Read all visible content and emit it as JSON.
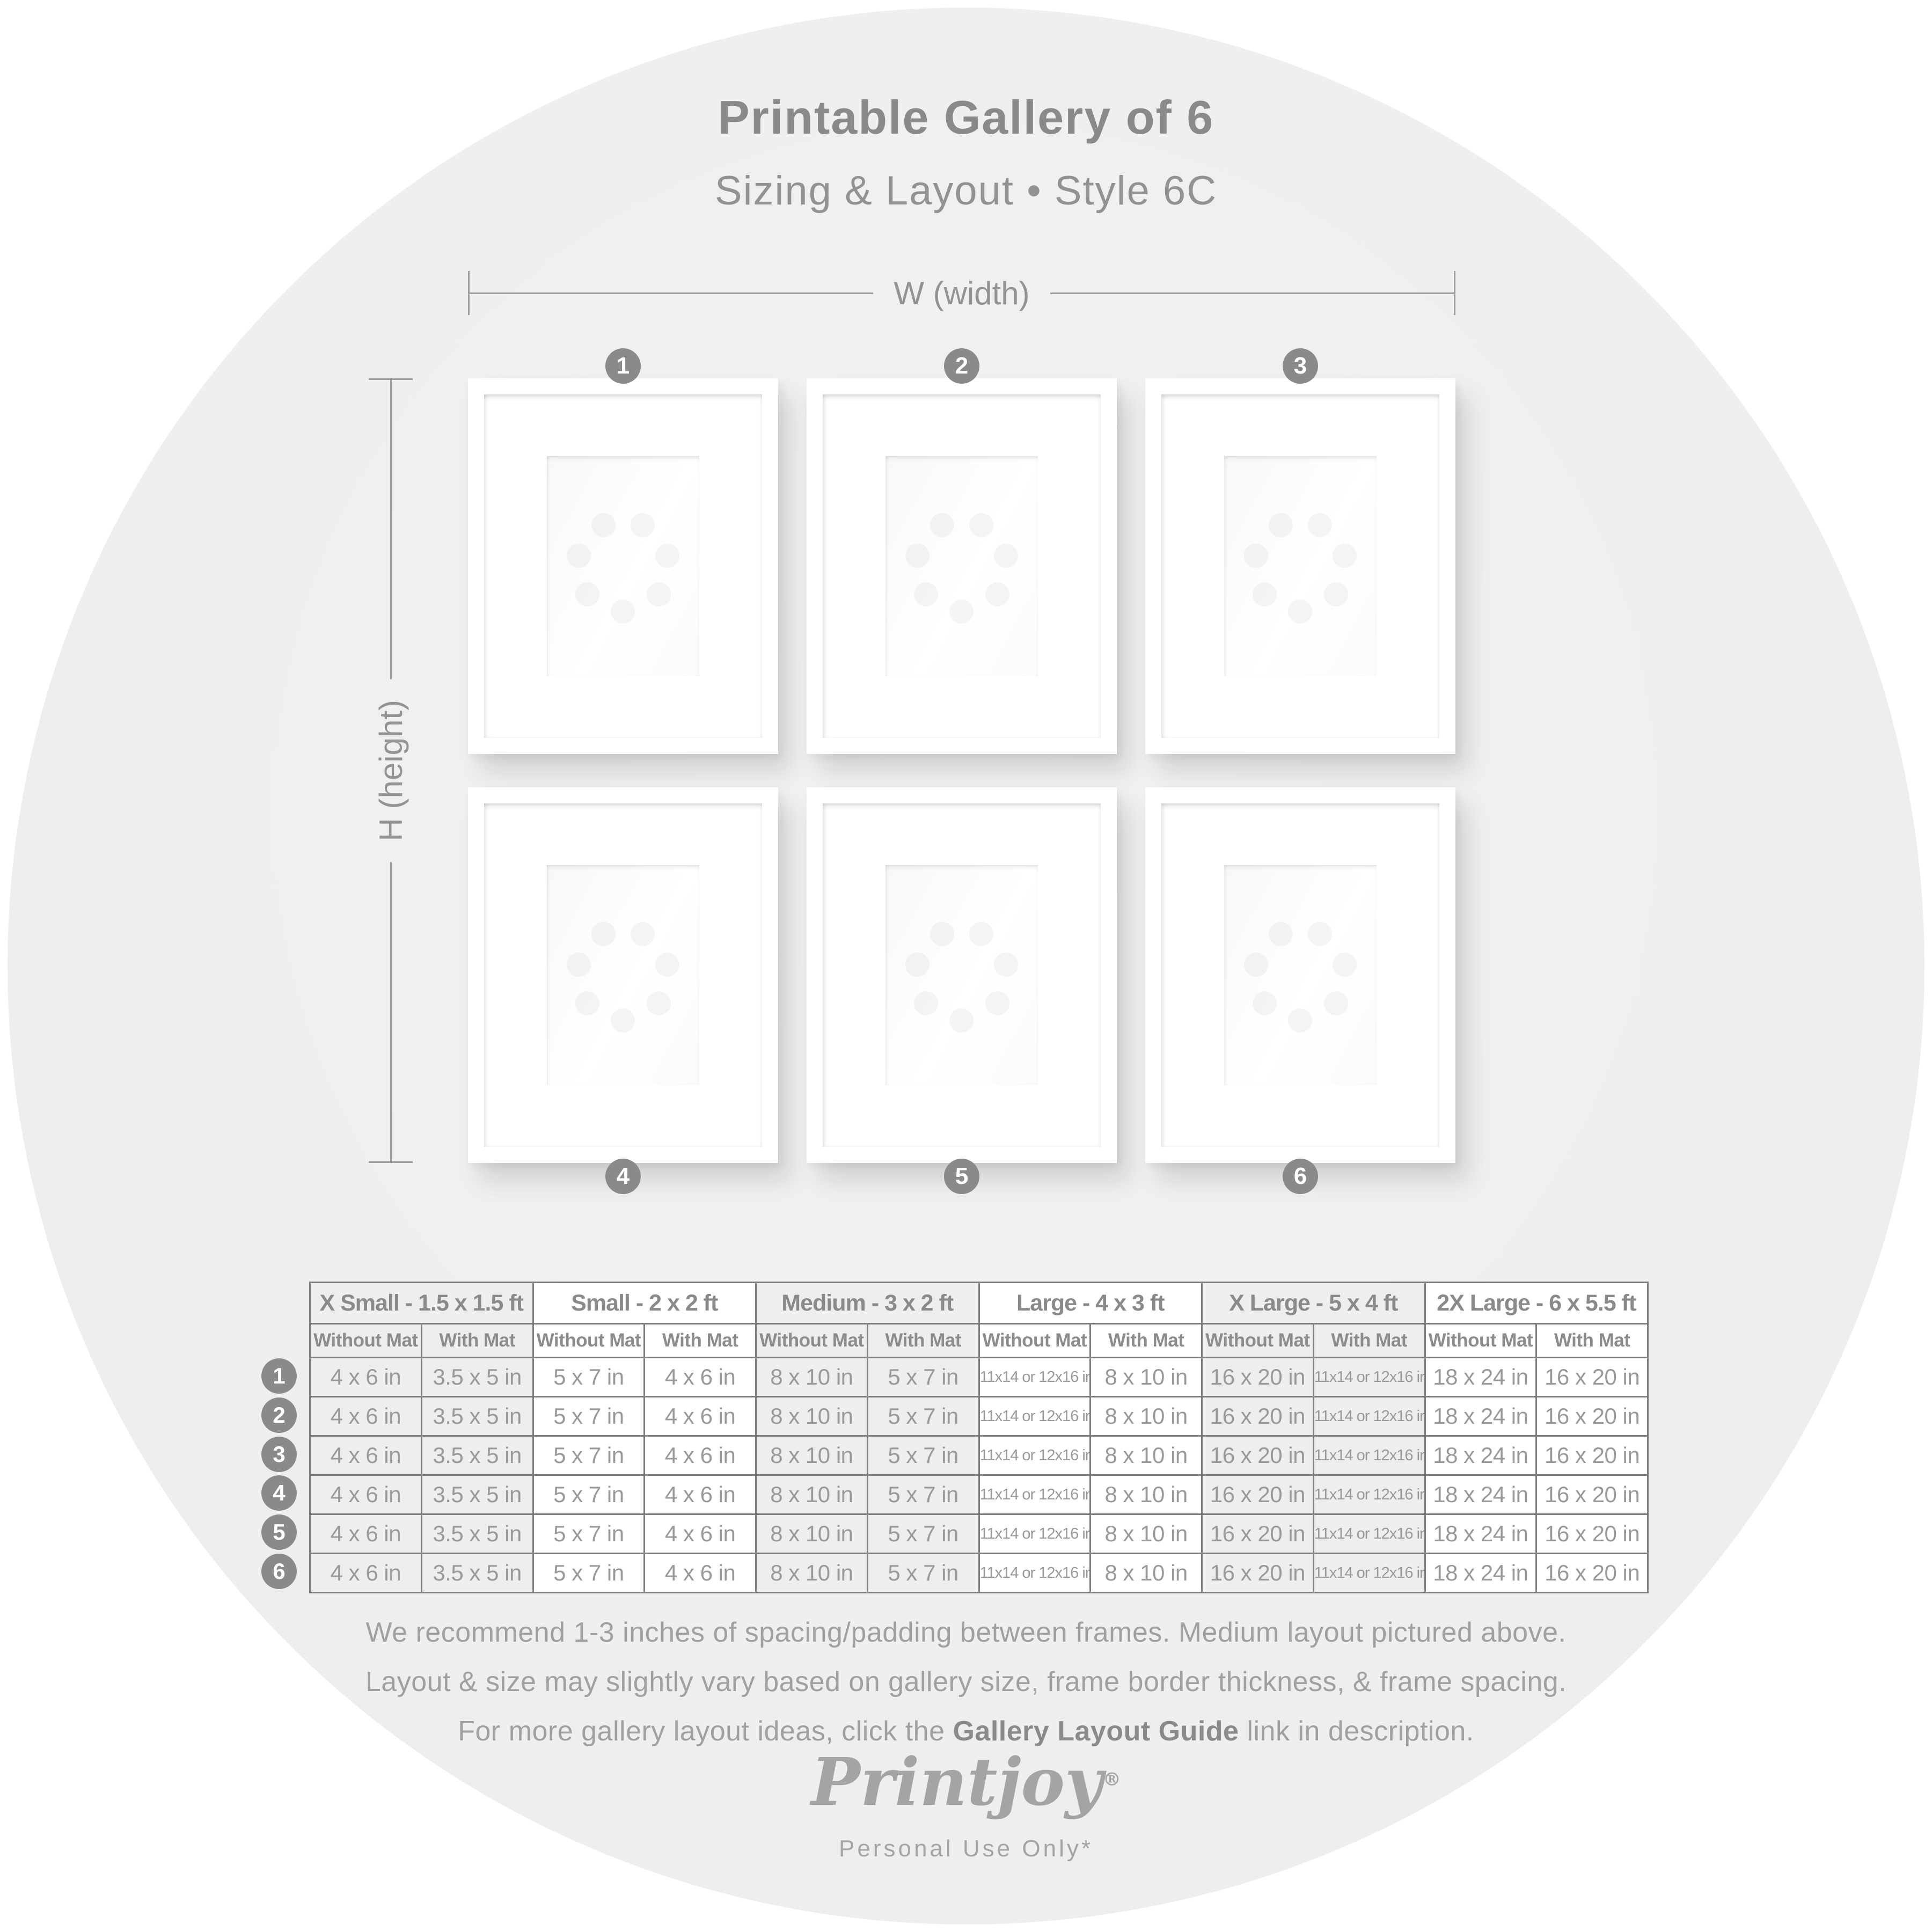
{
  "header": {
    "title": "Printable Gallery of 6",
    "subtitle": "Sizing & Layout • Style 6C"
  },
  "diagram": {
    "width_label": "W (width)",
    "height_label": "H (height)",
    "frame_numbers": [
      "1",
      "2",
      "3",
      "4",
      "5",
      "6"
    ]
  },
  "table": {
    "groups": [
      {
        "label": "X Small - 1.5 x 1.5 ft",
        "shaded": true
      },
      {
        "label": "Small - 2 x 2 ft",
        "shaded": false
      },
      {
        "label": "Medium - 3 x 2 ft",
        "shaded": true
      },
      {
        "label": "Large - 4 x 3 ft",
        "shaded": false
      },
      {
        "label": "X Large - 5 x 4 ft",
        "shaded": true
      },
      {
        "label": "2X Large - 6 x 5.5 ft",
        "shaded": false
      }
    ],
    "subheaders": [
      "Without Mat",
      "With Mat"
    ],
    "rows": [
      {
        "number": "1",
        "values": [
          "4 x 6 in",
          "3.5 x 5 in",
          "5 x 7 in",
          "4 x 6 in",
          "8 x 10 in",
          "5 x 7 in",
          "11x14 or 12x16 in",
          "8 x 10 in",
          "16 x 20 in",
          "11x14 or 12x16 in",
          "18 x 24 in",
          "16 x 20 in"
        ]
      },
      {
        "number": "2",
        "values": [
          "4 x 6 in",
          "3.5 x 5 in",
          "5 x 7 in",
          "4 x 6 in",
          "8 x 10 in",
          "5 x 7 in",
          "11x14 or 12x16 in",
          "8 x 10 in",
          "16 x 20 in",
          "11x14 or 12x16 in",
          "18 x 24 in",
          "16 x 20 in"
        ]
      },
      {
        "number": "3",
        "values": [
          "4 x 6 in",
          "3.5 x 5 in",
          "5 x 7 in",
          "4 x 6 in",
          "8 x 10 in",
          "5 x 7 in",
          "11x14 or 12x16 in",
          "8 x 10 in",
          "16 x 20 in",
          "11x14 or 12x16 in",
          "18 x 24 in",
          "16 x 20 in"
        ]
      },
      {
        "number": "4",
        "values": [
          "4 x 6 in",
          "3.5 x 5 in",
          "5 x 7 in",
          "4 x 6 in",
          "8 x 10 in",
          "5 x 7 in",
          "11x14 or 12x16 in",
          "8 x 10 in",
          "16 x 20 in",
          "11x14 or 12x16 in",
          "18 x 24 in",
          "16 x 20 in"
        ]
      },
      {
        "number": "5",
        "values": [
          "4 x 6 in",
          "3.5 x 5 in",
          "5 x 7 in",
          "4 x 6 in",
          "8 x 10 in",
          "5 x 7 in",
          "11x14 or 12x16 in",
          "8 x 10 in",
          "16 x 20 in",
          "11x14 or 12x16 in",
          "18 x 24 in",
          "16 x 20 in"
        ]
      },
      {
        "number": "6",
        "values": [
          "4 x 6 in",
          "3.5 x 5 in",
          "5 x 7 in",
          "4 x 6 in",
          "8 x 10 in",
          "5 x 7 in",
          "11x14 or 12x16 in",
          "8 x 10 in",
          "16 x 20 in",
          "11x14 or 12x16 in",
          "18 x 24 in",
          "16 x 20 in"
        ]
      }
    ]
  },
  "footer": {
    "line1": "We recommend 1-3 inches of spacing/padding between frames. Medium layout pictured above.",
    "line2": "Layout & size may slightly vary based on gallery size, frame border thickness, & frame spacing.",
    "line3_prefix": "For more gallery layout ideas, click the ",
    "line3_bold": "Gallery Layout Guide",
    "line3_suffix": " link in description."
  },
  "logo": {
    "brand": "Printjoy",
    "registered": "®",
    "tagline": "Personal Use Only*"
  },
  "colors": {
    "background": "#ffffff",
    "circle": "#efefef",
    "text_gray": "#8a8a8a",
    "light_text_gray": "#a0a0a0",
    "table_border": "#7d7d7d",
    "shaded_cell": "#eeeeef",
    "badge": "#8a8a8a"
  }
}
